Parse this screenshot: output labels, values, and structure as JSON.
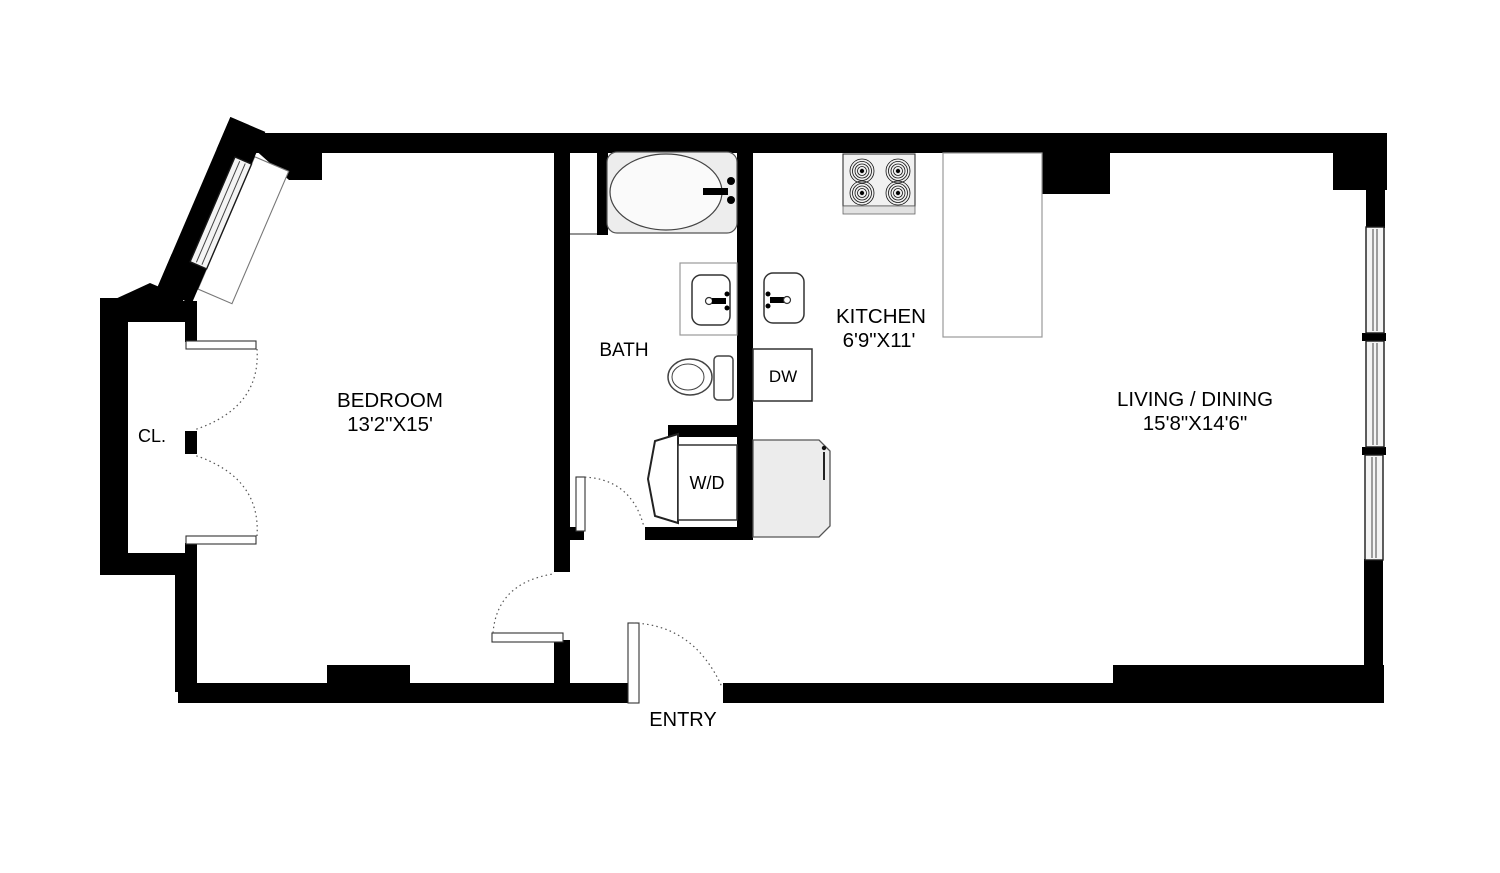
{
  "title": "Apartment floor plan",
  "colors": {
    "background": "#ffffff",
    "wall": "#000000",
    "fixture_fill": "#ededed",
    "fixture_stroke": "#555555",
    "window_fill": "#f4f4f4",
    "text": "#000000"
  },
  "rooms": {
    "bedroom": {
      "name": "BEDROOM",
      "dims": "13'2\"X15'"
    },
    "bath": {
      "name": "BATH"
    },
    "kitchen": {
      "name": "KITCHEN",
      "dims": "6'9\"X11'"
    },
    "living": {
      "name": "LIVING / DINING",
      "dims": "15'8\"X14'6\""
    },
    "closet": {
      "name": "CL."
    },
    "entry": {
      "name": "ENTRY"
    }
  },
  "appliances": {
    "washer_dryer": {
      "name": "W/D"
    },
    "dishwasher": {
      "name": "DW"
    }
  },
  "fixtures": [
    "bathtub",
    "bath-sink",
    "toilet",
    "kitchen-sink",
    "stove",
    "refrigerator",
    "kitchen-counter",
    "dishwasher",
    "washer-dryer"
  ],
  "windows": {
    "right_wall_count": 3,
    "diagonal_bay_count": 1
  }
}
